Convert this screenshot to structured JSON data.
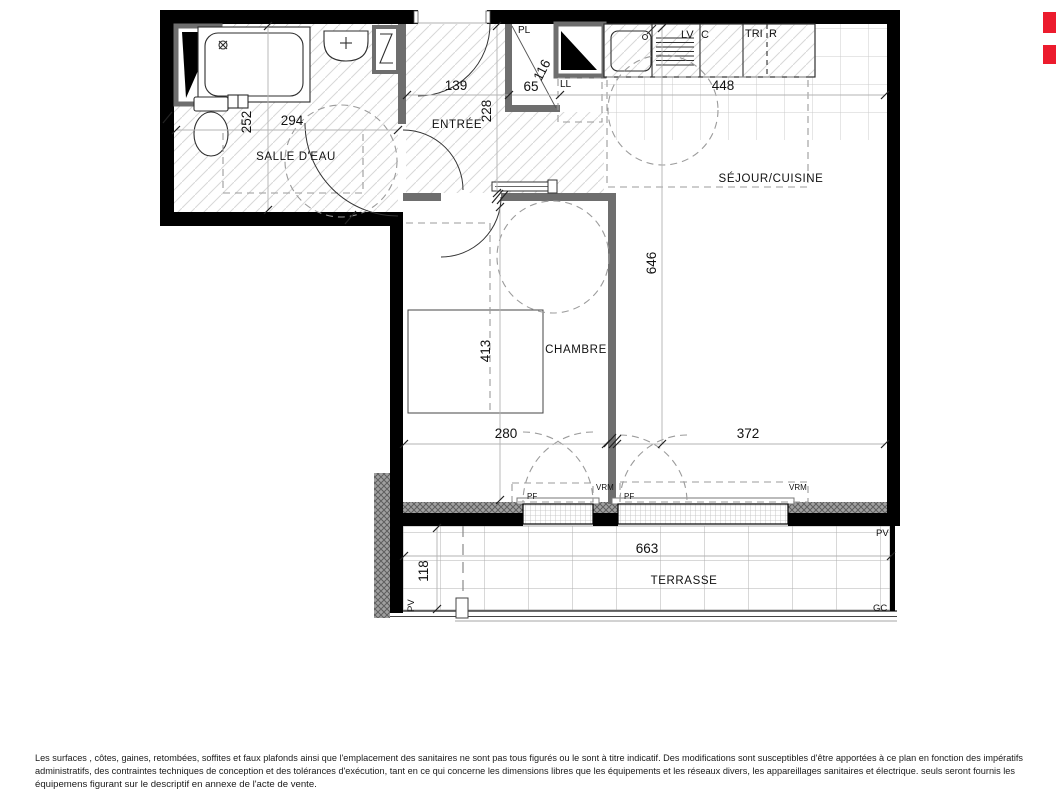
{
  "plan": {
    "type": "apartment-floor-plan",
    "room_labels": {
      "salle_deau": "SALLE D'EAU",
      "entree": "ENTRÉE",
      "sejour_cuisine": "SÉJOUR/CUISINE",
      "chambre": "CHAMBRE",
      "terrasse": "TERRASSE"
    },
    "dimensions_cm": {
      "salle_deau_depth": "252",
      "salle_deau_width": "294",
      "entree_width": "139",
      "entree_depth": "228",
      "placard_height": "116",
      "placard_width": "65",
      "cuisine_width": "448",
      "sejour_depth": "646",
      "chambre_depth": "413",
      "chambre_width": "280",
      "sejour_width": "372",
      "terrasse_width": "663",
      "terrasse_depth": "118"
    },
    "annotations": {
      "pl": "PL",
      "ll": "LL",
      "lv": "LV",
      "c": "C",
      "tri": "TRI",
      "r": "R",
      "pf_chambre": "PF",
      "pf_sejour": "PF",
      "vrm_chambre": "VRM",
      "vrm_sejour": "VRM",
      "pv_left": "PV",
      "pv_right": "PV",
      "gc": "GC"
    },
    "colors": {
      "wall": "#000000",
      "partition": "#6e6e6e",
      "accent_red": "#ec1b2d"
    }
  },
  "footer": {
    "line1": "Les surfaces , côtes, gaines, retombées, soffites et faux plafonds ainsi que l'emplacement des sanitaires ne sont pas tous figurés ou le sont à titre indicatif. Des modifications sont susceptibles d'être apportées à ce plan en fonction des impératifs",
    "line2": "administratifs, des contraintes techniques de conception et des tolérances d'exécution, tant en ce qui concerne les dimensions libres que les équipements et les réseaux divers, les appareillages sanitaires et électrique. seuls seront fournis les",
    "line3": "équipemens figurant sur le descriptif en annexe de l'acte de vente."
  }
}
